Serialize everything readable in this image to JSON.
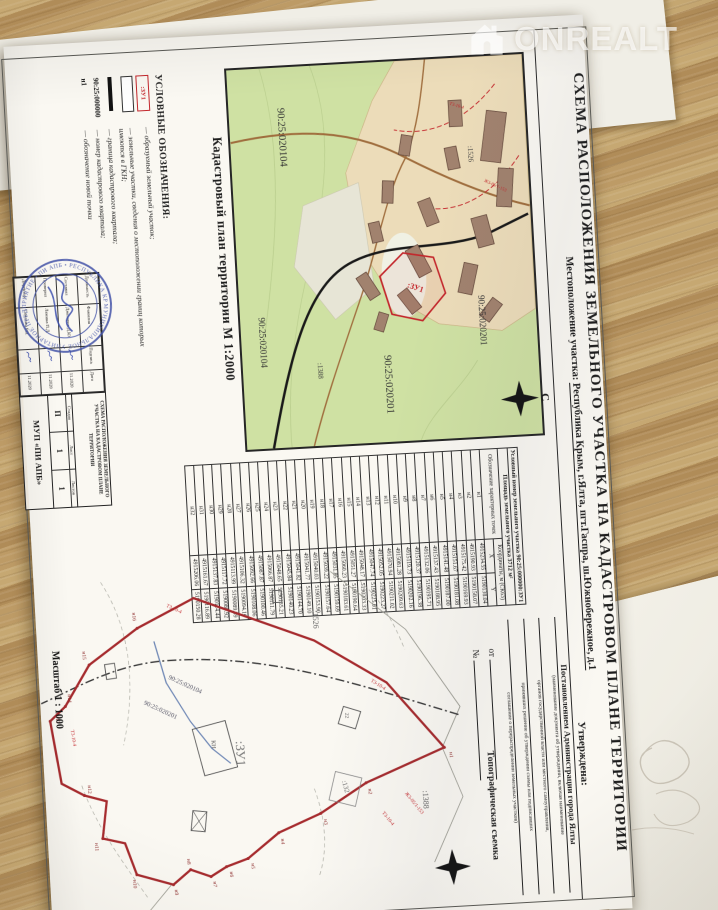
{
  "watermark": {
    "brand": "ONREALT"
  },
  "colors": {
    "accent_red": "#c3262b",
    "map_green": "#cfe1a3",
    "stamp_blue": "#4353a8",
    "wood": "#b8975f"
  },
  "document": {
    "title": "СХЕМА РАСПОЛОЖЕНИЯ ЗЕМЕЛЬНОГО УЧАСТКА НА КАДАСТРОВОМ ПЛАНЕ ТЕРРИТОРИИ",
    "location_label": "Местоположение участка:",
    "location_value": "Республика Крым, г.Ялта, пгт.Гаспра, ш.Южнобережное, д.1",
    "map1": {
      "caption": "Кадастровый план территории М 1:2000",
      "labels": {
        "q_020104_big": "90:25:020104",
        "q_020104_small": "90:25:020104",
        "q_020201_big": "90:25:020201",
        "q_020201_small": "90:25:020201",
        "parcel_new": ":ЗУ1",
        "p1526": ":1526",
        "p1388": ":1388",
        "zone_t3": "Т3-10-4",
        "zone_zh3": "Ж3-05/1-153",
        "north_letter": "С"
      }
    },
    "coord_table": {
      "header_line1": "Условный номер земельного участка 90:25:000000:ЗУ1",
      "header_line2": "Площадь земельного участка 3712 м²",
      "col_point": "Обозначение характерных точек",
      "col_coords": "Координаты, м (СК63)",
      "col_x": "X",
      "col_y": "Y",
      "rows": [
        [
          "н1",
          "4915234.55",
          "5190138.04"
        ],
        [
          "н2",
          "4915190.93",
          "5190158.07"
        ],
        [
          "н3",
          "4915175.42",
          "5190169.93"
        ],
        [
          "н4",
          "4915151.67",
          "5190181.08"
        ],
        [
          "н5",
          "4915141.48",
          "5190187.00"
        ],
        [
          "н6",
          "4915137.43",
          "5190188.95"
        ],
        [
          "н7",
          "4915132.06",
          "5190195.71"
        ],
        [
          "н8",
          "4915120.37",
          "5190196.38"
        ],
        [
          "н9",
          "4915119.73",
          "5190202.16"
        ],
        [
          "н10",
          "4915081.28",
          "5190209.63"
        ],
        [
          "н11",
          "4915070.94",
          "5190211.02"
        ],
        [
          "н12",
          "4915052.05",
          "5190223.27"
        ],
        [
          "н13",
          "4915047.74",
          "5190225.01"
        ],
        [
          "н14",
          "4915048.17",
          "5190203.33"
        ],
        [
          "н15",
          "4915051.27",
          "5190190.64"
        ],
        [
          "н16",
          "4915060.23",
          "5190183.61"
        ],
        [
          "н17",
          "4915031.85",
          "5190159.69"
        ],
        [
          "н18",
          "4915039.22",
          "5190157.64"
        ],
        [
          "н19",
          "4915040.03",
          "5190153.90"
        ],
        [
          "н20",
          "4915041.77",
          "5190149.10"
        ],
        [
          "н21",
          "4915041.82",
          "5190144.70"
        ],
        [
          "н22",
          "4915045.84",
          "5190140.23"
        ],
        [
          "н23",
          "4915048.65",
          "5190135.21"
        ],
        [
          "н24",
          "4915066.87",
          "5190111.79"
        ],
        [
          "н25",
          "4915087.87",
          "5190100.46"
        ],
        [
          "н26",
          "4915092.66",
          "5190108.06"
        ],
        [
          "н27",
          "4915106.32",
          "5190094.10"
        ],
        [
          "н28",
          "4915113.99",
          "5190089.59"
        ],
        [
          "н29",
          "4915117.72",
          "5190080.92"
        ],
        [
          "н30",
          "4915137.83",
          "5190114.44"
        ],
        [
          "н31",
          "4915161.67",
          "5190116.89"
        ],
        [
          "н32",
          "4915206.06",
          "5190150.28"
        ]
      ]
    },
    "approval": {
      "heading": "Утверждена:",
      "value": "Постановлением Администрации города Ялты",
      "caption1": "(наименование документа об утверждении, включая наименование",
      "caption2": "органов государственной власти или местного самоуправления,",
      "caption3": "принявших решение об утверждении схемы или подписавших",
      "caption4": "соглашение о перераспределении земельных участков)",
      "from_label": "от",
      "number_label": "№"
    },
    "legend": {
      "heading": "УСЛОВНЫЕ ОБОЗНАЧЕНИЯ:",
      "items": [
        {
          "symbol": ":ЗУ1",
          "text": "— образуемый земельный участок;"
        },
        {
          "symbol": "",
          "text": "— земельные участки, сведения о местоположении границ которых имеются в ГКН;"
        },
        {
          "symbol": "",
          "text": "— граница кадастрового квартала;"
        },
        {
          "symbol": "90:25:000000",
          "text": "— номер кадастрового квартала;"
        },
        {
          "symbol": "н1",
          "text": "— обозначение новой точки"
        }
      ]
    },
    "title_block": {
      "title": "СХЕМА РАСПОЛОЖЕНИЯ ЗЕМЕЛЬНОГО УЧАСТКА НА КАДАСТРОВОМ ПЛАНЕ ТЕРРИТОРИИ",
      "staff_header": [
        "Должность",
        "Фамилия",
        "Подпись",
        "Дата"
      ],
      "staff": [
        {
          "role": "Составил",
          "name": "Джепаров Д.Ю.",
          "date": "11.2020"
        },
        {
          "role": "Проверил",
          "name": "Лямина П.Д.",
          "date": "11.2020"
        },
        {
          "role": "Директор",
          "name": "Самохин Р.В.",
          "date": "11.2020"
        }
      ],
      "stage_label": "Стадия",
      "sheet_label": "Лист",
      "sheets_label": "Листов",
      "stage": "П",
      "sheet": "1",
      "sheets": "1",
      "org": "МУП «ПИ АПБ»"
    },
    "stamp": {
      "ring_text": "МУНИЦИПАЛЬНОЕ УНИТАРНОЕ ПРЕДПРИЯТИЕ • ПИ АПБ • РЕСПУБЛИКА КРЫМ •"
    },
    "map2": {
      "caption_left": "Масштаб 1 : 1000",
      "caption_right": "Топографическая съемка",
      "labels": {
        "parcel_new": ":ЗУ1",
        "p1526": ":1526",
        "p1388": ":1388",
        "p132": ":132",
        "q_020104": "90:25:020104",
        "q_020201": "90:25:020201",
        "zone_t3_a": "Т3-10-4",
        "zone_t3_b": "Т3-10-4",
        "zone_t3_c": "Т3-10-4",
        "zone_t3_d": "Т3-10-4",
        "zone_zh3": "Ж3-05/1-153",
        "bld_kn": "КН",
        "bld_22": "22"
      },
      "points": [
        "н1",
        "н2",
        "н3",
        "н4",
        "н5",
        "н6",
        "н7",
        "н8",
        "н9",
        "н10",
        "н11",
        "н12",
        "н13",
        "н14",
        "н15",
        "н16"
      ]
    }
  }
}
